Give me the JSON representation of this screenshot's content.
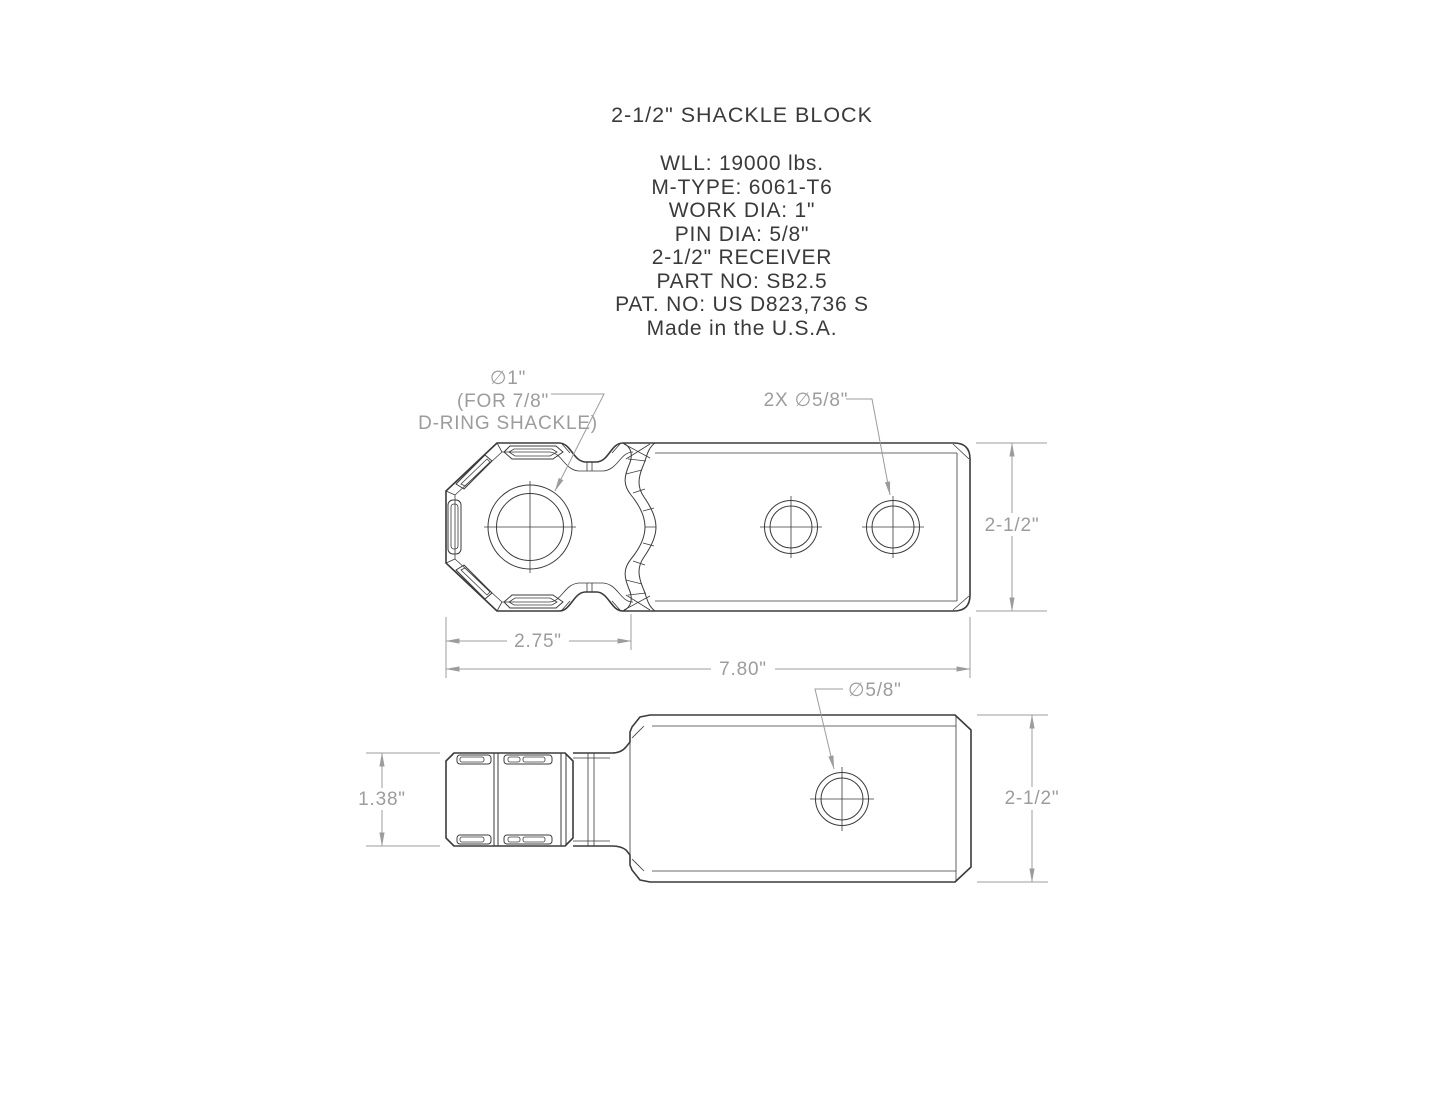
{
  "title": "2-1/2\" SHACKLE BLOCK",
  "specs": {
    "lines": [
      "WLL: 19000 lbs.",
      "M-TYPE: 6061-T6",
      "WORK DIA: 1\"",
      "PIN DIA: 5/8\"",
      "2-1/2\" RECEIVER",
      "PART NO: SB2.5",
      "PAT. NO: US D823,736 S",
      "Made in the U.S.A."
    ]
  },
  "top_view": {
    "labels": {
      "hole_dia": "∅1\"",
      "hole_note1": "(FOR 7/8\"",
      "hole_note2": "D-RING SHACKLE)",
      "pin_holes": "2X ∅5/8\""
    },
    "dims": {
      "head_length": "2.75\"",
      "overall_length": "7.80\"",
      "height": "2-1/2\""
    }
  },
  "side_view": {
    "labels": {
      "pin_hole": "∅5/8\""
    },
    "dims": {
      "shackle_width": "1.38\"",
      "height": "2-1/2\""
    }
  },
  "colors": {
    "background": "#ffffff",
    "part_line": "#3b3b3b",
    "dimension": "#9c9c9c"
  }
}
